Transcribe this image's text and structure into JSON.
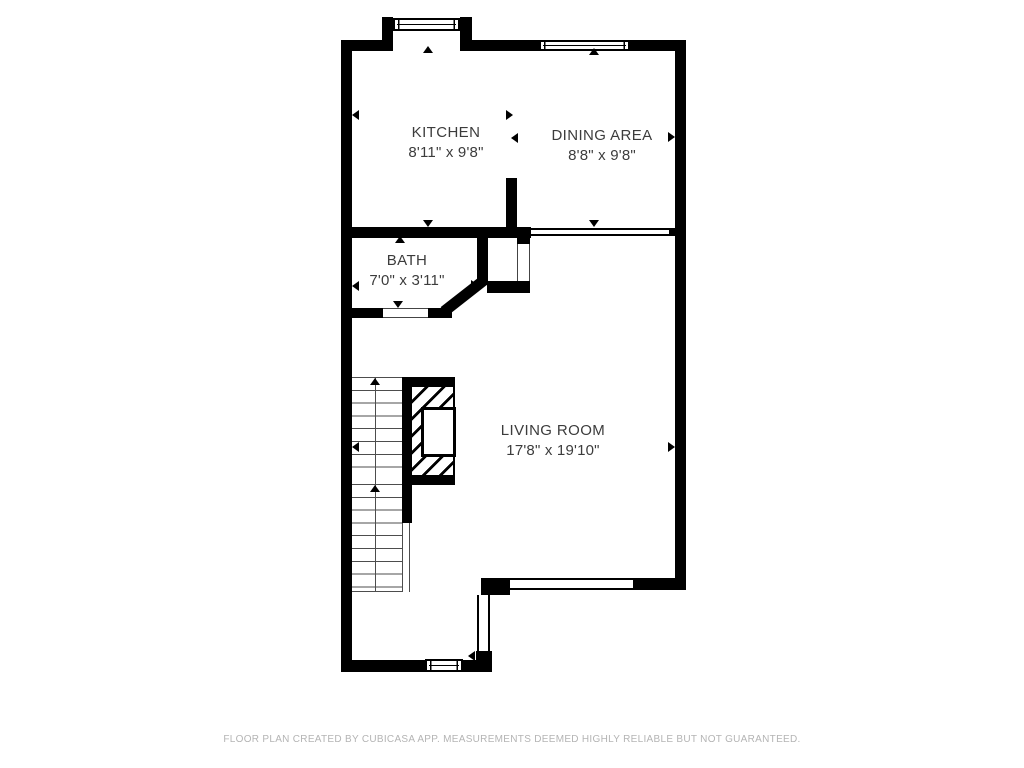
{
  "floorplan": {
    "rooms": [
      {
        "id": "kitchen",
        "name": "KITCHEN",
        "dims": "8'11\" x 9'8\""
      },
      {
        "id": "dining",
        "name": "DINING AREA",
        "dims": "8'8\" x 9'8\""
      },
      {
        "id": "bath",
        "name": "BATH",
        "dims": "7'0\" x 3'11\""
      },
      {
        "id": "living",
        "name": "LIVING ROOM",
        "dims": "17'8\" x 19'10\""
      }
    ],
    "colors": {
      "wall": "#000000",
      "label_text": "#3c3c3c",
      "footer_text": "#b4b4b4",
      "background": "#ffffff"
    }
  },
  "footer": {
    "disclaimer": "FLOOR PLAN CREATED BY CUBICASA APP. MEASUREMENTS DEEMED HIGHLY RELIABLE BUT NOT GUARANTEED."
  }
}
